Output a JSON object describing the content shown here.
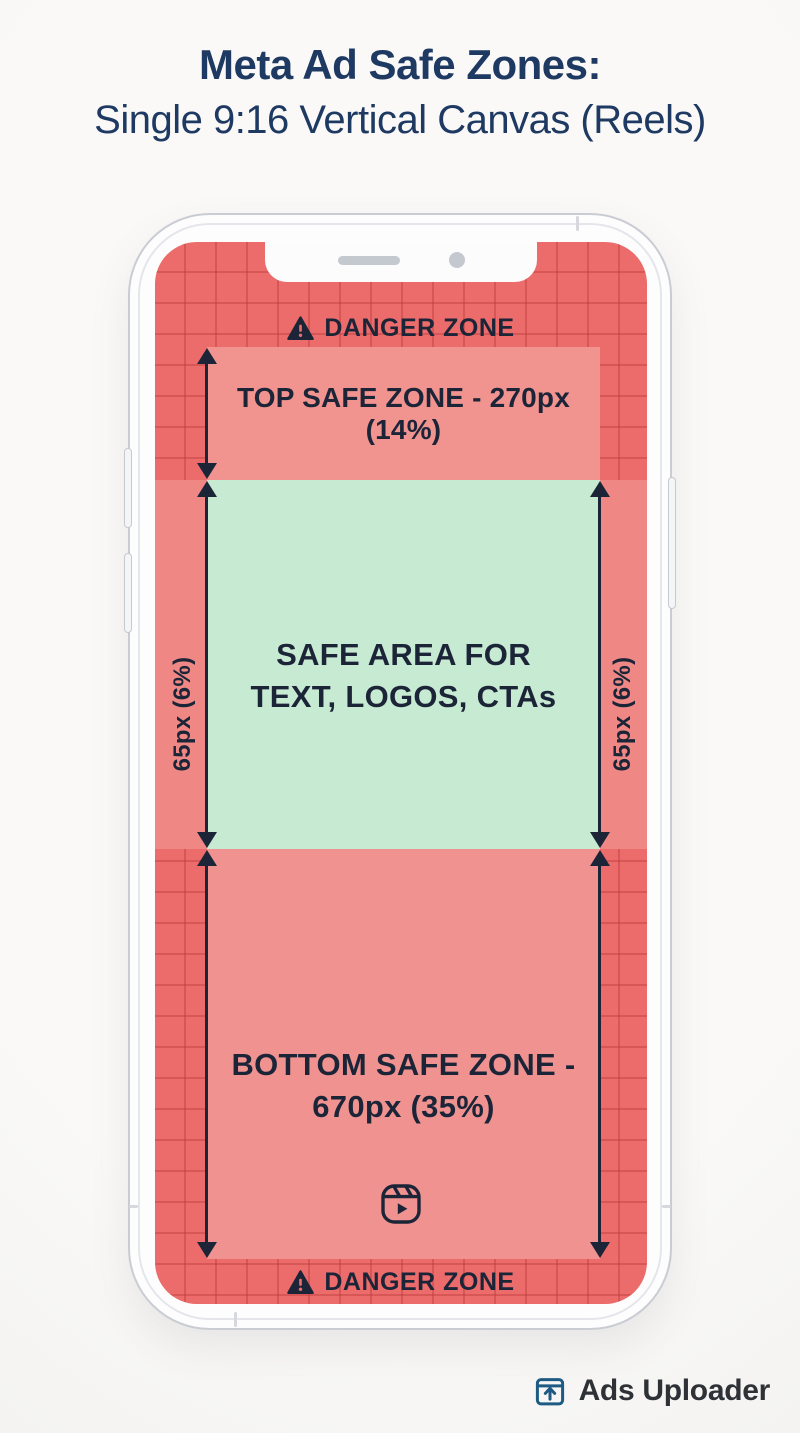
{
  "title": {
    "line1": "Meta Ad Safe Zones:",
    "line2": "Single 9:16 Vertical Canvas (Reels)"
  },
  "phone": {
    "top_danger": {
      "icon": "warning-triangle-icon",
      "label": "DANGER ZONE"
    },
    "top_safe_zone": {
      "label": "TOP SAFE ZONE - 270px (14%)"
    },
    "safe_area": {
      "line1": "SAFE AREA FOR",
      "line2": "TEXT, LOGOS, CTAs"
    },
    "left_margin": {
      "label": "65px (6%)"
    },
    "right_margin": {
      "label": "65px (6%)"
    },
    "bottom_safe_zone": {
      "line1": "BOTTOM SAFE ZONE -",
      "line2": "670px (35%)",
      "icon": "reels-icon"
    },
    "bottom_danger": {
      "icon": "warning-triangle-icon",
      "label": "DANGER ZONE"
    }
  },
  "branding": {
    "icon": "upload-box-icon",
    "name": "Ads Uploader"
  },
  "colors": {
    "background": "#f8f7f5",
    "title_navy": "#1e3a63",
    "text_navy": "#1c2538",
    "danger_red": "#ec6b6b",
    "safe_zone_red": "#f1938f",
    "margin_red": "#ef8884",
    "safe_area_green": "#c7ead2",
    "brand_blue": "#1d5b84"
  }
}
